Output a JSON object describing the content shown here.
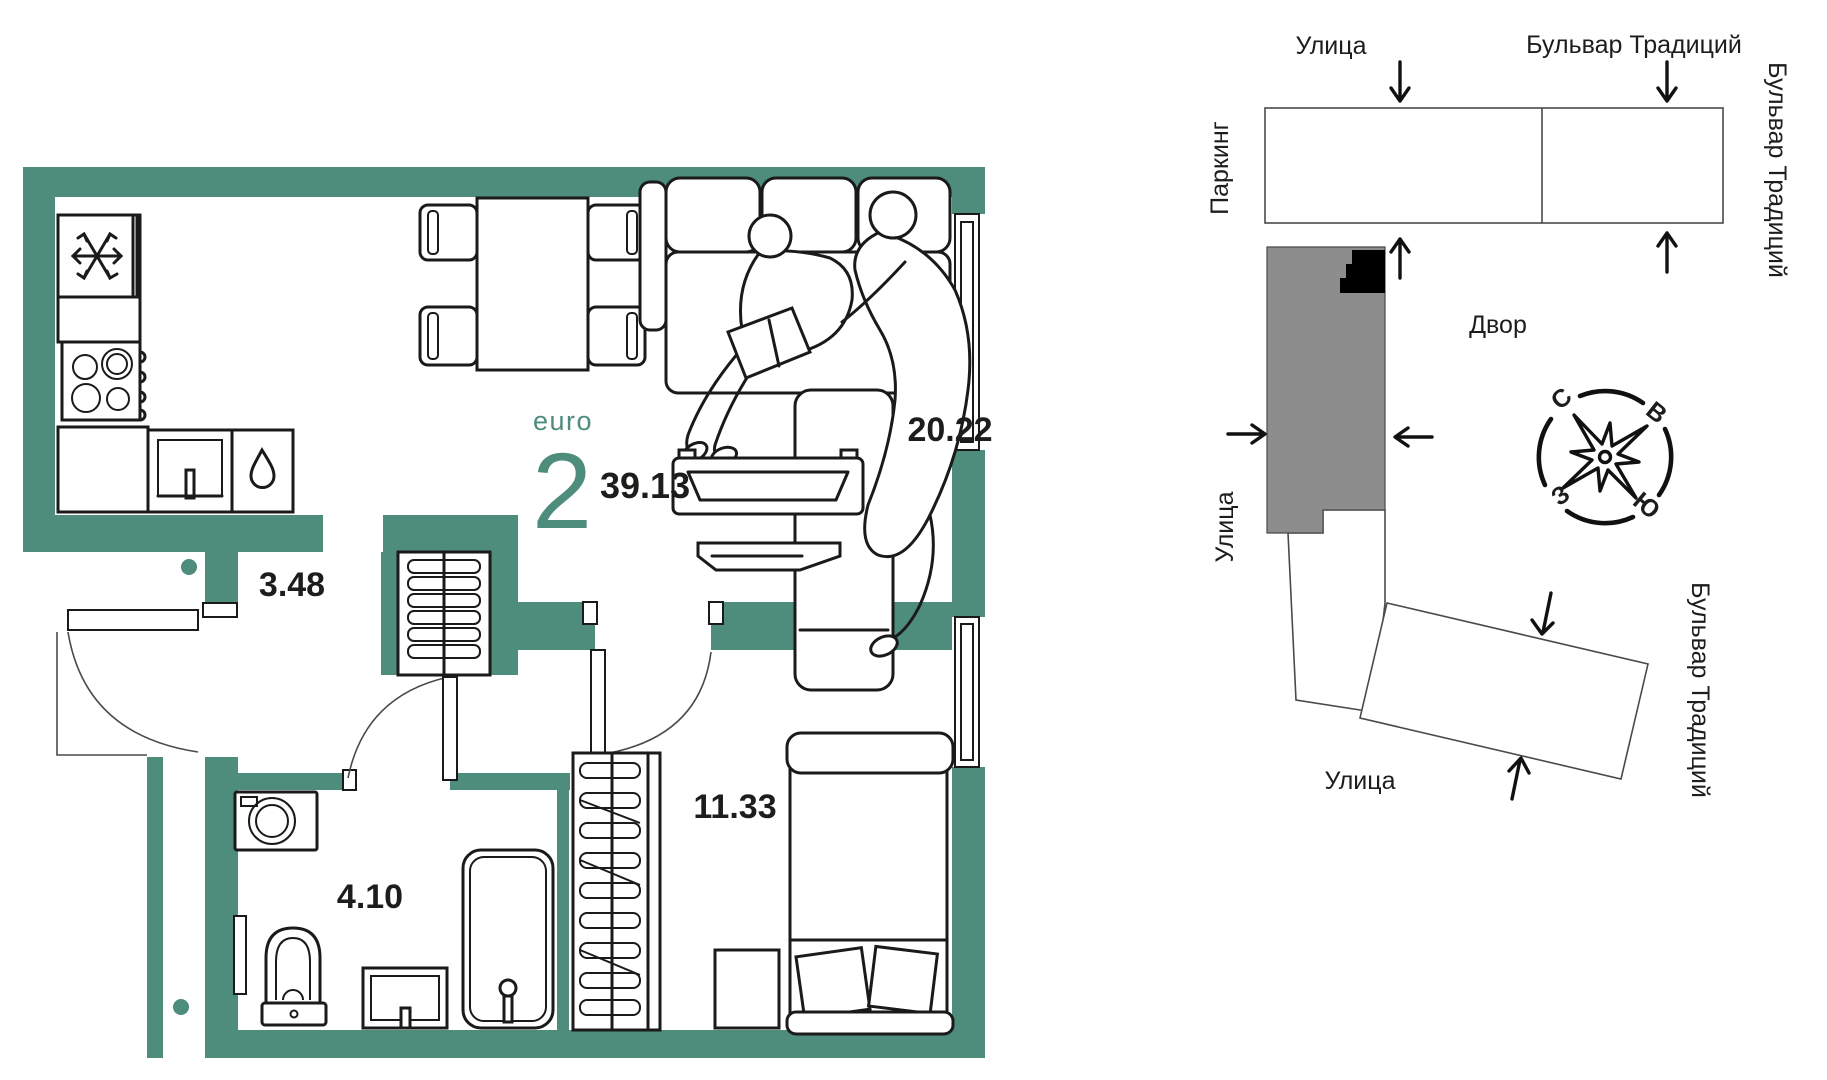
{
  "plan": {
    "type_label": "euro",
    "rooms_count": "2",
    "total_area": "39.13",
    "areas": {
      "living": "20.22",
      "hall": "3.48",
      "bath": "4.10",
      "bedroom": "11.33"
    }
  },
  "map": {
    "street_top": "Улица",
    "boulevard_top": "Бульвар Традиций",
    "boulevard_right": "Бульвар Традиций",
    "boulevard_right_lower": "Бульвар Традиций",
    "parking": "Паркинг",
    "yard": "Двор",
    "street_left": "Улица",
    "street_bottom": "Улица",
    "compass": {
      "n": "С",
      "e": "В",
      "w": "З",
      "s": "Ю"
    }
  },
  "colors": {
    "wall_teal": "#4e8c7c",
    "accent_teal": "#4e8c7c",
    "ink": "#1d1d1b",
    "building_gray": "#8d8d8d",
    "building_black": "#000000"
  }
}
